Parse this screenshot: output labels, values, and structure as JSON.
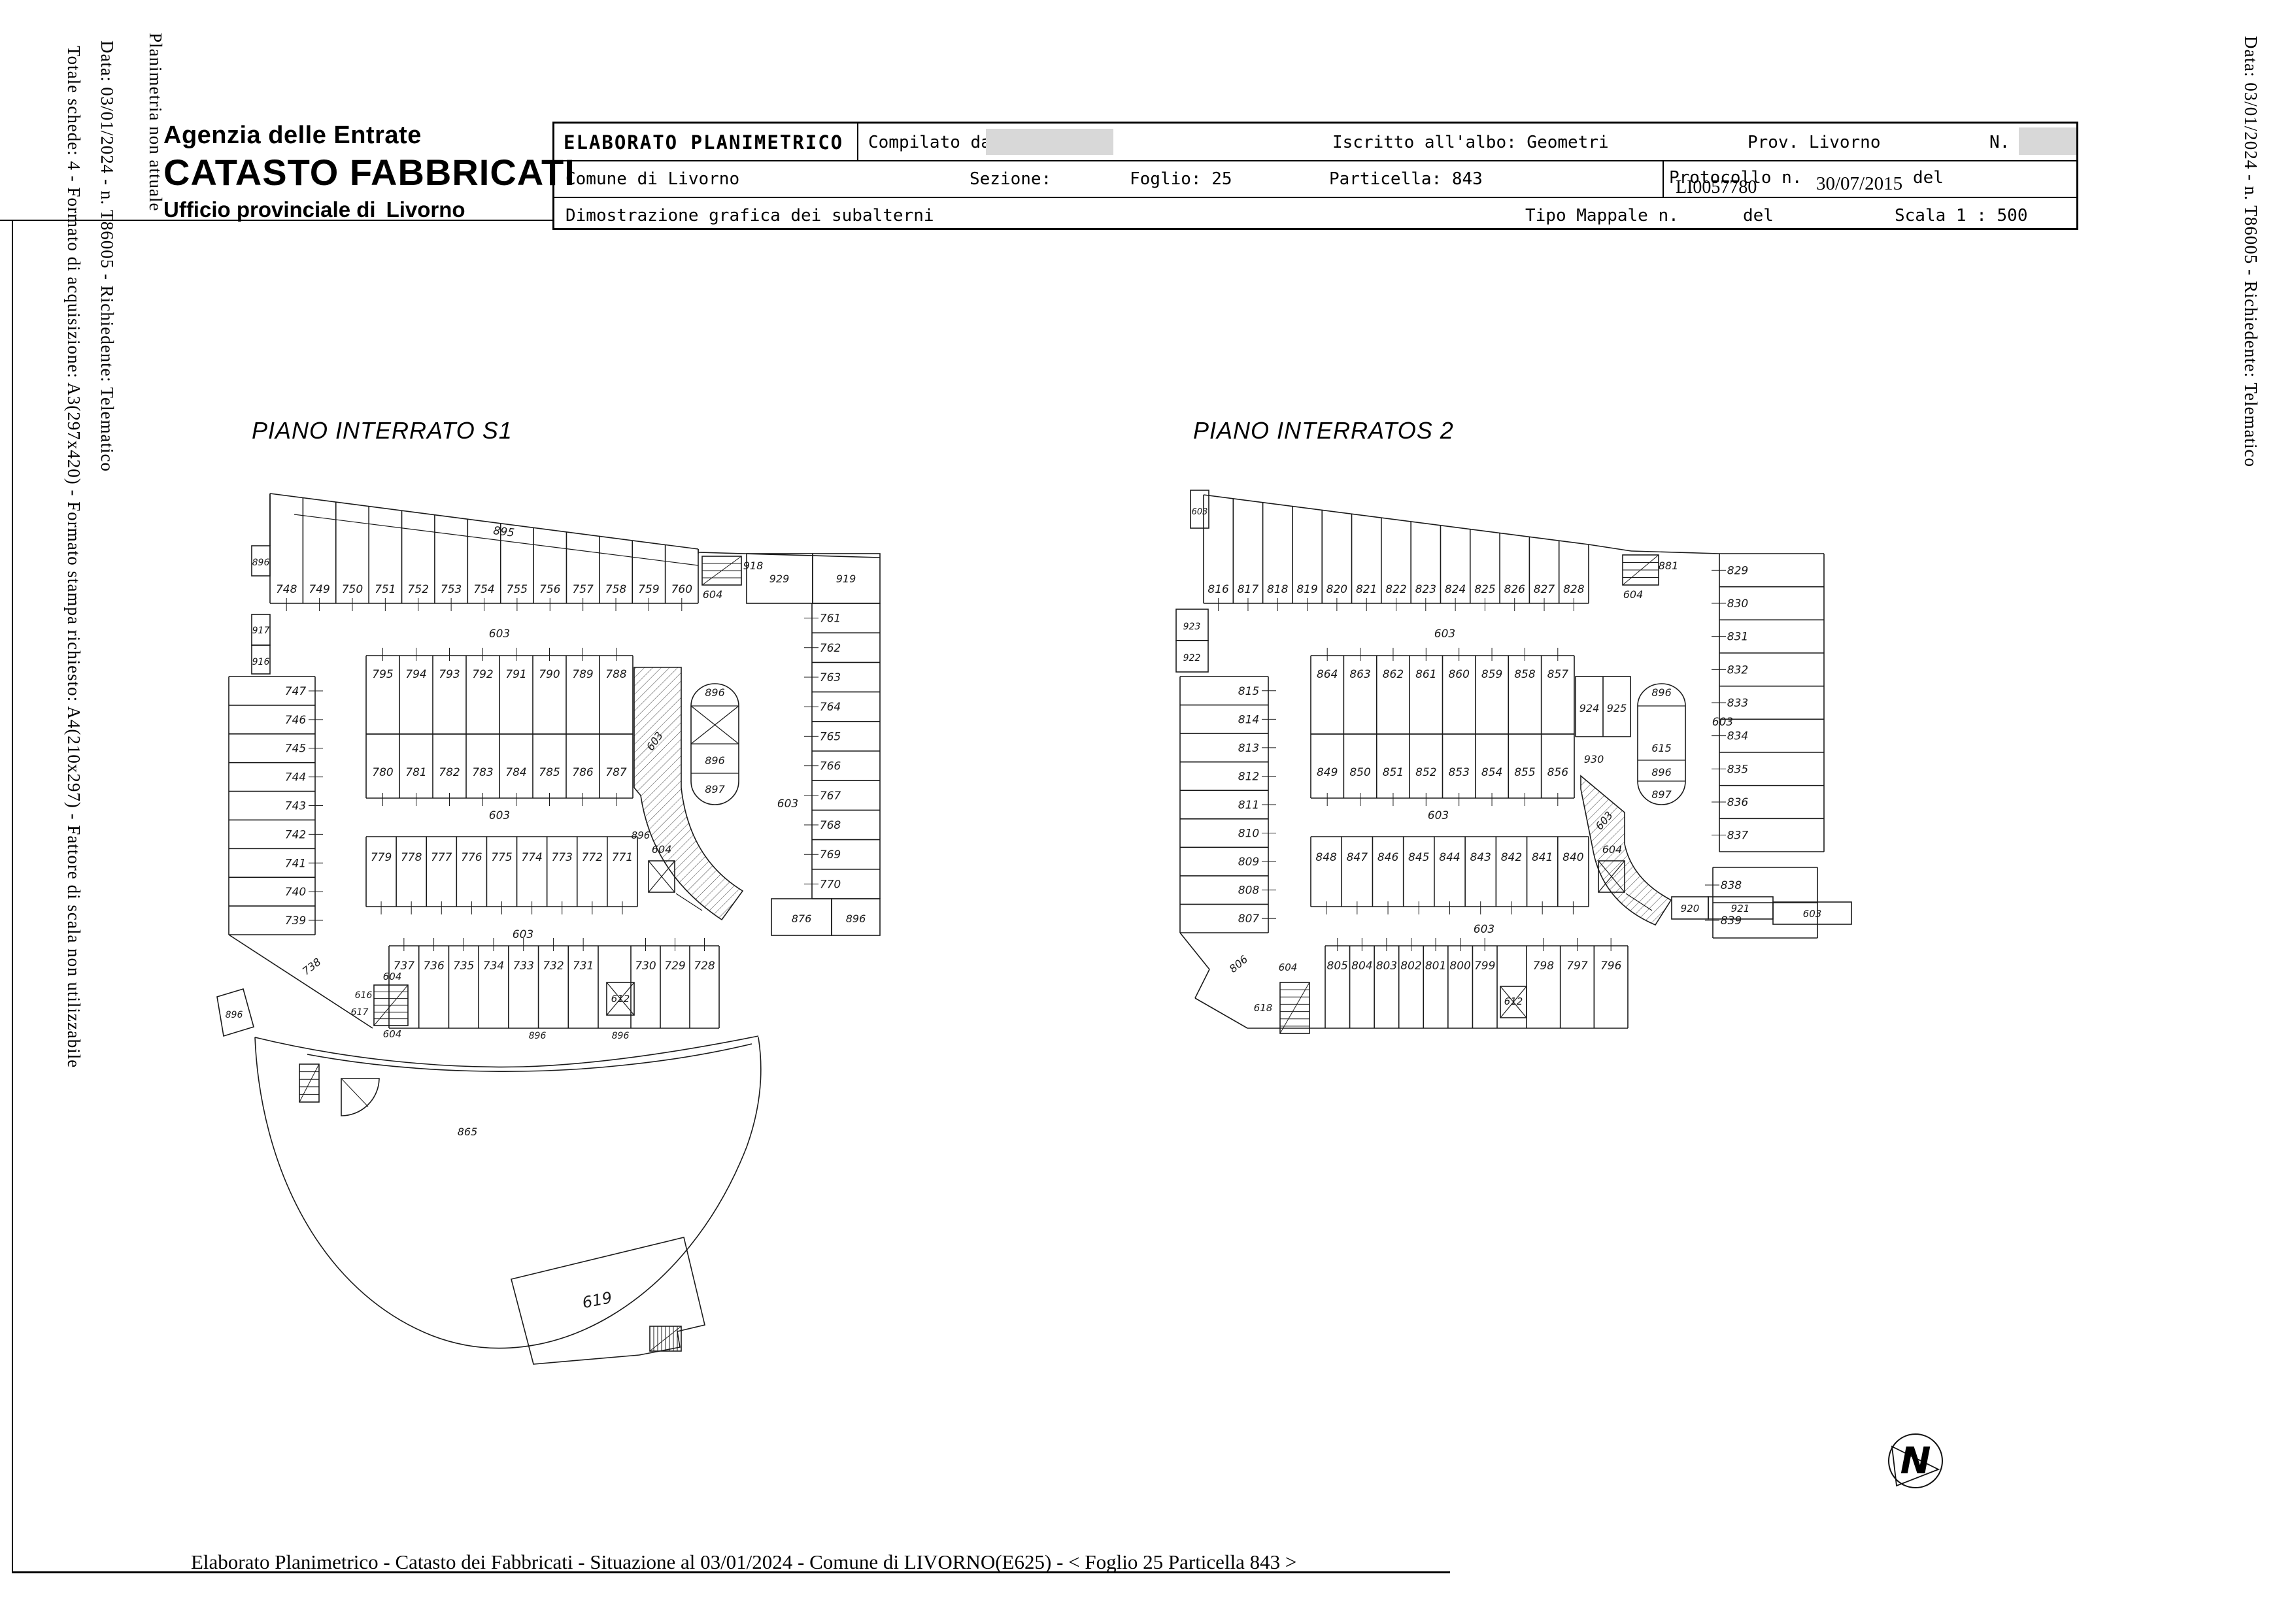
{
  "page": {
    "side_texts": {
      "left_outer": "Totale schede: 4 - Formato di acquisizione: A3(297x420)  - Formato stampa richiesto: A4(210x297) - Fattore di scala non utilizzabile",
      "left_middle": "Data: 03/01/2024 - n. T86005 - Richiedente: Telematico",
      "left_inner": "Planimetria non attuale",
      "right": "Data: 03/01/2024 - n. T86005 - Richiedente: Telematico"
    },
    "footer": "Elaborato Planimetrico - Catasto dei Fabbricati - Situazione al 03/01/2024 - Comune di LIVORNO(E625) - < Foglio 25 Particella 843 >"
  },
  "logo": {
    "line1": "Agenzia delle Entrate",
    "line2": "CATASTO FABBRICATI",
    "line3": "Ufficio provinciale di",
    "city": "Livorno"
  },
  "header_table": {
    "title": "ELABORATO PLANIMETRICO",
    "compilato": "Compilato da:",
    "iscritto": "Iscritto all'albo: Geometri",
    "prov": "Prov. Livorno",
    "n_label": "N.",
    "comune": "Comune di Livorno",
    "sezione": "Sezione:",
    "foglio": "Foglio: 25",
    "particella": "Particella: 843",
    "protocollo": "Protocollo n.",
    "protocollo_overlap": "LI0057780",
    "data_protocollo": "30/07/2015",
    "del1": "del",
    "dimostrazione": "Dimostrazione grafica dei subalterni",
    "tipo_mappale": "Tipo Mappale n.",
    "del2": "del",
    "scala": "Scala 1 : 500"
  },
  "north_letter": "N",
  "plans": [
    {
      "title": "PIANO INTERRATO S1",
      "corridor_label": "895",
      "top_row": [
        "748",
        "749",
        "750",
        "751",
        "752",
        "753",
        "754",
        "755",
        "756",
        "757",
        "758",
        "759",
        "760"
      ],
      "stair_top_right": "918",
      "stair_top_below": "604",
      "top_right_boxes": [
        "929",
        "919"
      ],
      "right_column": [
        "761",
        "762",
        "763",
        "764",
        "765",
        "766",
        "767",
        "768",
        "769",
        "770"
      ],
      "left_edge_boxes": [
        "896",
        "917",
        "916"
      ],
      "left_column": [
        "747",
        "746",
        "745",
        "744",
        "743",
        "742",
        "741",
        "740",
        "739"
      ],
      "corner_label": "738",
      "block_upper": [
        "795",
        "794",
        "793",
        "792",
        "791",
        "790",
        "789",
        "788"
      ],
      "block_lower": [
        "780",
        "781",
        "782",
        "783",
        "784",
        "785",
        "786",
        "787"
      ],
      "third_row": [
        "779",
        "778",
        "777",
        "776",
        "775",
        "774",
        "773",
        "772",
        "771"
      ],
      "mid_elevator": "604",
      "island_labels": [
        "896",
        "896",
        "897"
      ],
      "ramp_label": "603",
      "ramp_side_label": "896",
      "drive_labels": [
        "603",
        "603",
        "603"
      ],
      "side_label": "603",
      "right_mid_boxes": [
        "876",
        "896"
      ],
      "stair_bottom_labels": [
        "604",
        "616",
        "617",
        "604"
      ],
      "bottom_left_label": "896",
      "bottom_row_left": [
        "737",
        "736",
        "735",
        "734",
        "733",
        "732",
        "731"
      ],
      "bottom_elevator": "612",
      "bottom_row_right": [
        "730",
        "729",
        "728"
      ],
      "bottom_labels": [
        "896",
        "896"
      ],
      "area_label": "865",
      "building_label": "619"
    },
    {
      "title": "PIANO INTERRATOS 2",
      "corner_box_label": "603",
      "top_row": [
        "816",
        "817",
        "818",
        "819",
        "820",
        "821",
        "822",
        "823",
        "824",
        "825",
        "826",
        "827",
        "828"
      ],
      "stair_top_right": "881",
      "stair_top_below": "604",
      "right_column": [
        "829",
        "830",
        "831",
        "832",
        "833",
        "834",
        "835",
        "836",
        "837"
      ],
      "right_column_lower": [
        "838",
        "839"
      ],
      "left_edge_boxes": [
        "923",
        "922"
      ],
      "left_column": [
        "815",
        "814",
        "813",
        "812",
        "811",
        "810",
        "809",
        "808",
        "807"
      ],
      "corner_label": "806",
      "block_upper": [
        "864",
        "863",
        "862",
        "861",
        "860",
        "859",
        "858",
        "857"
      ],
      "block_lower": [
        "849",
        "850",
        "851",
        "852",
        "853",
        "854",
        "855",
        "856"
      ],
      "pair_box": [
        "924",
        "925"
      ],
      "pair_box_below": "930",
      "third_row": [
        "848",
        "847",
        "846",
        "845",
        "844",
        "843",
        "842",
        "841",
        "840"
      ],
      "mid_elevator": "604",
      "island_labels": [
        "896",
        "615",
        "896",
        "897"
      ],
      "ramp_label": "603",
      "drive_labels": [
        "603",
        "603",
        "603"
      ],
      "side_label": "603",
      "bottom_right_boxes": [
        "920",
        "921",
        "603"
      ],
      "stair_bottom_labels": [
        "604",
        "618"
      ],
      "bottom_row_left": [
        "805",
        "804",
        "803",
        "802",
        "801",
        "800",
        "799"
      ],
      "bottom_elevator": "612",
      "bottom_row_right": [
        "798",
        "797",
        "796"
      ]
    }
  ]
}
